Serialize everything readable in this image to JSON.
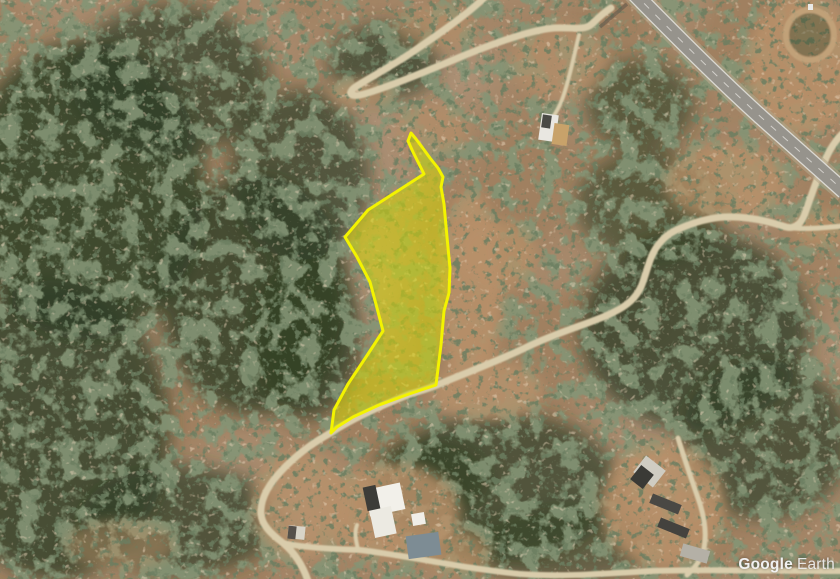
{
  "app": {
    "watermark": {
      "brand": "Google",
      "product": "Earth"
    }
  },
  "map": {
    "colors": {
      "terrain_base": "#a08060",
      "terrain_tone": "#7d5f45",
      "veg_underlay": "#2f3f26",
      "dirt_patch": "#b8916a",
      "road_dirt": "#d9ccab",
      "highway_shoulder": "#b3a58a",
      "highway_base": "#96938c",
      "highway_line": "#dedcd6",
      "highway_dash": "#d8d6d0",
      "parcel_fill": "rgba(219,219,0,0.52)",
      "parcel_stroke": "#f3f300",
      "pool": "#7d8c94"
    },
    "parcel": {
      "name": "highlighted-land-parcel",
      "points": "411,133 416,139 422,147 430,158 438,168 443,177 441,187 444,204 447,237 450,268 449,293 444,311 441,345 436,385 409,394 379,405 353,417 337,427 331,433 334,410 348,384 366,357 383,331 377,308 370,282 357,257 345,237 368,210 396,192 424,174 419,164 413,152 408,141"
    },
    "terrain": {
      "vegetation_zones": [
        {
          "cx": 85,
          "cy": 190,
          "rx": 120,
          "ry": 150,
          "op": 0.85
        },
        {
          "cx": 55,
          "cy": 430,
          "rx": 115,
          "ry": 150,
          "op": 0.8
        },
        {
          "cx": 170,
          "cy": 80,
          "rx": 100,
          "ry": 75,
          "op": 0.7
        },
        {
          "cx": 255,
          "cy": 295,
          "rx": 95,
          "ry": 120,
          "op": 0.8
        },
        {
          "cx": 300,
          "cy": 175,
          "rx": 70,
          "ry": 85,
          "op": 0.7
        },
        {
          "cx": 383,
          "cy": 62,
          "rx": 55,
          "ry": 38,
          "op": 0.7
        },
        {
          "cx": 500,
          "cy": 487,
          "rx": 120,
          "ry": 75,
          "op": 0.7
        },
        {
          "cx": 695,
          "cy": 330,
          "rx": 115,
          "ry": 100,
          "op": 0.75
        },
        {
          "cx": 765,
          "cy": 440,
          "rx": 85,
          "ry": 80,
          "op": 0.7
        },
        {
          "cx": 640,
          "cy": 105,
          "rx": 55,
          "ry": 45,
          "op": 0.6
        },
        {
          "cx": 650,
          "cy": 205,
          "rx": 75,
          "ry": 55,
          "op": 0.6
        },
        {
          "cx": 180,
          "cy": 520,
          "rx": 100,
          "ry": 55,
          "op": 0.7
        },
        {
          "cx": 305,
          "cy": 335,
          "rx": 55,
          "ry": 85,
          "op": 0.75
        },
        {
          "cx": 430,
          "cy": 478,
          "rx": 60,
          "ry": 42,
          "op": 0.6
        },
        {
          "cx": 560,
          "cy": 545,
          "rx": 90,
          "ry": 38,
          "op": 0.55
        }
      ],
      "clearings": [
        {
          "cx": 470,
          "cy": 290,
          "rx": 32,
          "ry": 100,
          "op": 0.85
        },
        {
          "cx": 497,
          "cy": 255,
          "rx": 40,
          "ry": 35,
          "op": 0.7
        },
        {
          "cx": 487,
          "cy": 390,
          "rx": 55,
          "ry": 30,
          "op": 0.8
        },
        {
          "cx": 392,
          "cy": 512,
          "rx": 68,
          "ry": 48,
          "op": 0.85
        },
        {
          "cx": 455,
          "cy": 552,
          "rx": 35,
          "ry": 22,
          "op": 0.7
        },
        {
          "cx": 300,
          "cy": 505,
          "rx": 48,
          "ry": 55,
          "op": 0.8
        },
        {
          "cx": 663,
          "cy": 505,
          "rx": 62,
          "ry": 62,
          "op": 0.85
        },
        {
          "cx": 802,
          "cy": 65,
          "rx": 55,
          "ry": 70,
          "op": 0.85
        },
        {
          "cx": 725,
          "cy": 182,
          "rx": 60,
          "ry": 38,
          "op": 0.75
        },
        {
          "cx": 560,
          "cy": 62,
          "rx": 48,
          "ry": 38,
          "op": 0.6
        },
        {
          "cx": 362,
          "cy": 93,
          "rx": 32,
          "ry": 14,
          "op": 0.8
        },
        {
          "cx": 432,
          "cy": 130,
          "rx": 36,
          "ry": 26,
          "op": 0.6
        },
        {
          "cx": 822,
          "cy": 228,
          "rx": 30,
          "ry": 18,
          "op": 0.7
        },
        {
          "cx": 120,
          "cy": 545,
          "rx": 55,
          "ry": 25,
          "op": 0.5
        },
        {
          "cx": 435,
          "cy": 28,
          "rx": 40,
          "ry": 22,
          "op": 0.5
        }
      ]
    },
    "roads": [
      {
        "name": "hairpin-road",
        "width": 7,
        "d": "M 486,-4 C 468,14 436,36 408,55 C 385,70 362,82 354,88 C 348,93 350,97 360,95 C 378,91 420,74 458,58 C 492,44 530,30 554,28 C 572,27 584,31 592,24 C 597,19 603,13 611,8"
      },
      {
        "name": "house-driveway",
        "width": 4,
        "d": "M 579,35 C 574,55 570,77 563,97 C 558,111 552,119 547,124"
      },
      {
        "name": "main-dirt-road",
        "width": 7,
        "d": "M 308,581 C 303,566 295,553 283,543 C 270,533 262,525 261,514 C 260,500 267,485 285,467 C 305,447 322,438 332,432 C 352,419 380,406 410,394 C 424,390 432,387 437,385 C 468,372 498,361 527,347 C 560,331 592,323 612,313 C 629,305 636,297 641,287 C 647,272 649,259 656,248 C 663,237 673,231 681,228 C 695,222 708,218 724,217 C 747,216 768,221 786,227 C 794,229 800,225 804,216 C 810,200 816,180 826,158 C 831,147 836,140 842,134"
      },
      {
        "name": "east-branch-road",
        "width": 5,
        "d": "M 786,227 C 803,230 822,228 842,226"
      },
      {
        "name": "bottom-road",
        "width": 6,
        "d": "M 283,543 C 300,547 330,549 360,550 C 410,556 460,568 520,574 C 560,577 600,574 650,571 C 700,569 760,571 842,571"
      },
      {
        "name": "farm-track",
        "width": 5,
        "d": "M 678,438 C 684,458 691,478 698,498 C 704,515 707,533 704,548 C 701,560 694,569 687,575"
      },
      {
        "name": "villa-spur",
        "width": 4,
        "d": "M 358,549 C 356,541 354,533 357,525"
      }
    ],
    "roundabout": {
      "name": "roundabout-circle",
      "cx": 810,
      "cy": 35,
      "rx": 24,
      "ry": 25,
      "ring": "#c3a47b"
    },
    "highway": {
      "name": "highway",
      "center_d": "M 633,-8 C 672,32 720,80 762,118 C 790,143 815,165 845,192",
      "edge_left_d": "M 627,-3 C 666,37 714,85 756,123 C 784,148 809,170 839,197",
      "edge_right_d": "M 639,-13 C 678,27 726,75 768,113 C 796,138 821,160 851,187",
      "shadow_d": "M 600,27 L 627,4"
    },
    "buildings": [
      {
        "name": "top-house-white",
        "x": 540,
        "y": 114,
        "w": 17,
        "h": 27,
        "rot": 8,
        "fill": "#e9e7e1"
      },
      {
        "name": "top-house-dark-roof",
        "x": 542,
        "y": 115,
        "w": 9,
        "h": 13,
        "rot": 8,
        "fill": "#4a4a46"
      },
      {
        "name": "top-house-tan",
        "x": 553,
        "y": 124,
        "w": 15,
        "h": 21,
        "rot": 8,
        "fill": "#c8a26a"
      },
      {
        "name": "villa-main",
        "x": 367,
        "y": 486,
        "w": 36,
        "h": 27,
        "rot": -12,
        "fill": "#f2f0ea"
      },
      {
        "name": "villa-wing",
        "x": 372,
        "y": 508,
        "w": 22,
        "h": 28,
        "rot": -12,
        "fill": "#eceae2"
      },
      {
        "name": "villa-dark-section",
        "x": 365,
        "y": 486,
        "w": 13,
        "h": 24,
        "rot": -12,
        "fill": "#3c3c38"
      },
      {
        "name": "villa-shed",
        "x": 412,
        "y": 513,
        "w": 13,
        "h": 12,
        "rot": -10,
        "fill": "#f0eee8"
      },
      {
        "name": "villa-pool",
        "x": 407,
        "y": 534,
        "w": 33,
        "h": 23,
        "rot": -8,
        "fill": "#7d8c94"
      },
      {
        "name": "roadside-shed",
        "x": 288,
        "y": 526,
        "w": 17,
        "h": 13,
        "rot": 6,
        "fill": "#d8d4c8"
      },
      {
        "name": "roadside-shed-roof",
        "x": 288,
        "y": 526,
        "w": 8,
        "h": 13,
        "rot": 6,
        "fill": "#55504a"
      },
      {
        "name": "farm-building-white",
        "x": 637,
        "y": 461,
        "w": 25,
        "h": 21,
        "rot": 38,
        "fill": "#cfccc2"
      },
      {
        "name": "farm-building-roof",
        "x": 634,
        "y": 468,
        "w": 16,
        "h": 18,
        "rot": 38,
        "fill": "#3a3a36"
      },
      {
        "name": "farm-shed-1",
        "x": 650,
        "y": 499,
        "w": 31,
        "h": 10,
        "rot": 22,
        "fill": "#4a4844"
      },
      {
        "name": "farm-shed-2",
        "x": 658,
        "y": 523,
        "w": 31,
        "h": 10,
        "rot": 22,
        "fill": "#44423e"
      },
      {
        "name": "farm-shed-3",
        "x": 681,
        "y": 547,
        "w": 28,
        "h": 13,
        "rot": 16,
        "fill": "#b4b0a6"
      },
      {
        "name": "highway-sign",
        "x": 808,
        "y": 4,
        "w": 5,
        "h": 6,
        "rot": 0,
        "fill": "#e9e9e7"
      }
    ]
  }
}
